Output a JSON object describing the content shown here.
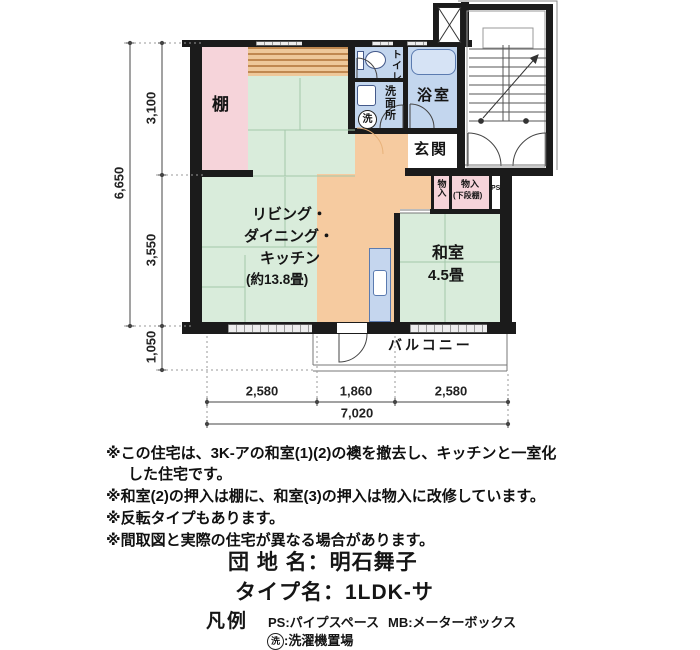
{
  "plan": {
    "rooms": {
      "shelf": "棚",
      "ldk_line1": "リビング・",
      "ldk_line2": "ダイニング・",
      "ldk_line3": "キッチン",
      "ldk_size": "(約13.8畳)",
      "washitsu": "和室",
      "washitsu_size": "4.5畳",
      "toilet": "トイレ",
      "washroom": "洗面所",
      "laundry_symbol": "洗",
      "bath": "浴室",
      "entrance": "玄関",
      "closet_small": "物入",
      "closet_wide_line1": "物入",
      "closet_wide_line2": "(下段棚)",
      "ps": "PS",
      "balcony": "バルコニー"
    },
    "dimensions": {
      "total_height": "6,650",
      "upper_height": "3,100",
      "middle_height": "3,550",
      "balcony_depth": "1,050",
      "bottom_left": "2,580",
      "bottom_center": "1,860",
      "bottom_right": "2,580",
      "total_width": "7,020"
    }
  },
  "notes": [
    "※この住宅は、3K-アの和室(1)(2)の襖を撤去し、キッチンと一室化",
    "した住宅です。",
    "※和室(2)の押入は棚に、和室(3)の押入は物入に改修しています。",
    "※反転タイプもあります。",
    "※間取図と実際の住宅が異なる場合があります。"
  ],
  "titles": {
    "estate_label": "団 地 名：明石舞子",
    "type_label": "タイプ名：1LDK-サ"
  },
  "legend": {
    "heading": "凡例",
    "ps": "PS:パイプスペース",
    "mb": "MB:メーターボックス",
    "laundry_symbol": "洗",
    "laundry_text": ":洗濯機置場"
  },
  "colors": {
    "wall": "#1b1b1b",
    "tatami_green": "#d9ecdb",
    "shelf_pink": "#f6d4da",
    "kitchen_orange": "#f6cba0",
    "water_blue": "#c3d6ee",
    "band_brown": "#c8904f"
  }
}
